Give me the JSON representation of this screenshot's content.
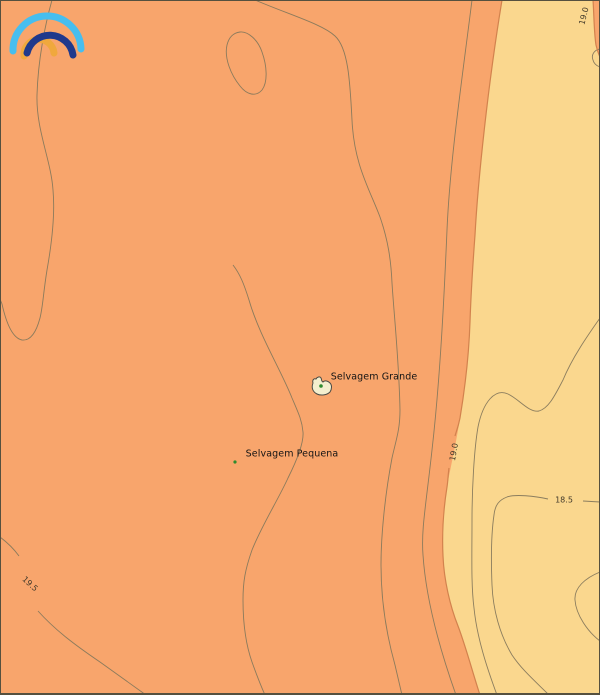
{
  "map": {
    "title": "sea-surface-temperature-contour-map",
    "logo": {
      "name": "ipma-rainbow-logo",
      "outer_arc_color": "#47BEEF",
      "middle_arc_color": "#20398C",
      "inner_arc_color": "#F0A83D"
    },
    "regions": {
      "warm_fill": "#F8A56C",
      "cool_fill": "#FAD78E",
      "boundary_stroke": "#D2824E",
      "contour_stroke": "#85785C",
      "border_color": "#55503F"
    },
    "places": {
      "selvagem_grande": "Selvagem Grande",
      "selvagem_pequena": "Selvagem Pequena"
    },
    "islands": {
      "island_fill": "#F4EFCE",
      "island_stroke": "#4A4A44",
      "dot_color": "#2E8B2E"
    },
    "contour_labels": [
      {
        "value": "19.0",
        "position": "top-right"
      },
      {
        "value": "19.0",
        "position": "mid-right"
      },
      {
        "value": "18.5",
        "position": "right"
      },
      {
        "value": "19.5",
        "position": "bottom-left"
      }
    ]
  }
}
